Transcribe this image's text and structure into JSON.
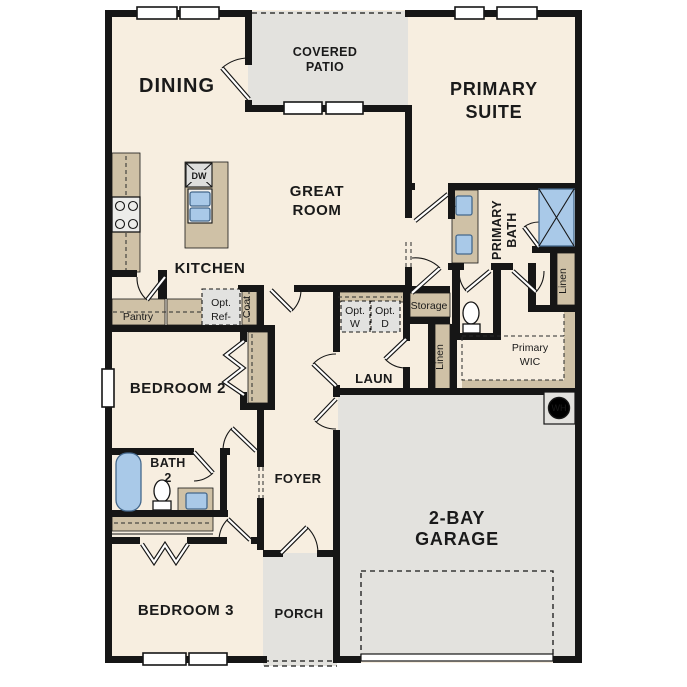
{
  "colors": {
    "floor": "#f7eee0",
    "outdoor_concrete": "#e3e2de",
    "cabinet_tan": "#cfc1a6",
    "fixture_blue": "#a9c9e8",
    "wall_black": "#161616"
  },
  "rooms": {
    "dining": "DINING",
    "covered_patio": [
      "COVERED",
      "PATIO"
    ],
    "primary_suite": [
      "PRIMARY",
      "SUITE"
    ],
    "great_room": [
      "GREAT",
      "ROOM"
    ],
    "kitchen": "KITCHEN",
    "primary_bath": [
      "PRIMARY",
      "BATH"
    ],
    "primary_wic": [
      "Primary",
      "WIC"
    ],
    "laundry": "LAUN",
    "bedroom2": "BEDROOM 2",
    "bath2": [
      "BATH",
      "2"
    ],
    "foyer": "FOYER",
    "bedroom3": "BEDROOM 3",
    "porch": "PORCH",
    "garage": [
      "2-BAY",
      "GARAGE"
    ]
  },
  "closets": {
    "pantry": "Pantry",
    "coat": "Coat",
    "storage": "Storage",
    "linen_hall": "Linen",
    "linen_bath": "Linen"
  },
  "appliances": {
    "dishwasher": "DW",
    "water_heater": "WH",
    "opt_washer": [
      "Opt.",
      "W"
    ],
    "opt_dryer": [
      "Opt.",
      "D"
    ],
    "opt_fridge": [
      "Opt.",
      "Ref-"
    ]
  }
}
